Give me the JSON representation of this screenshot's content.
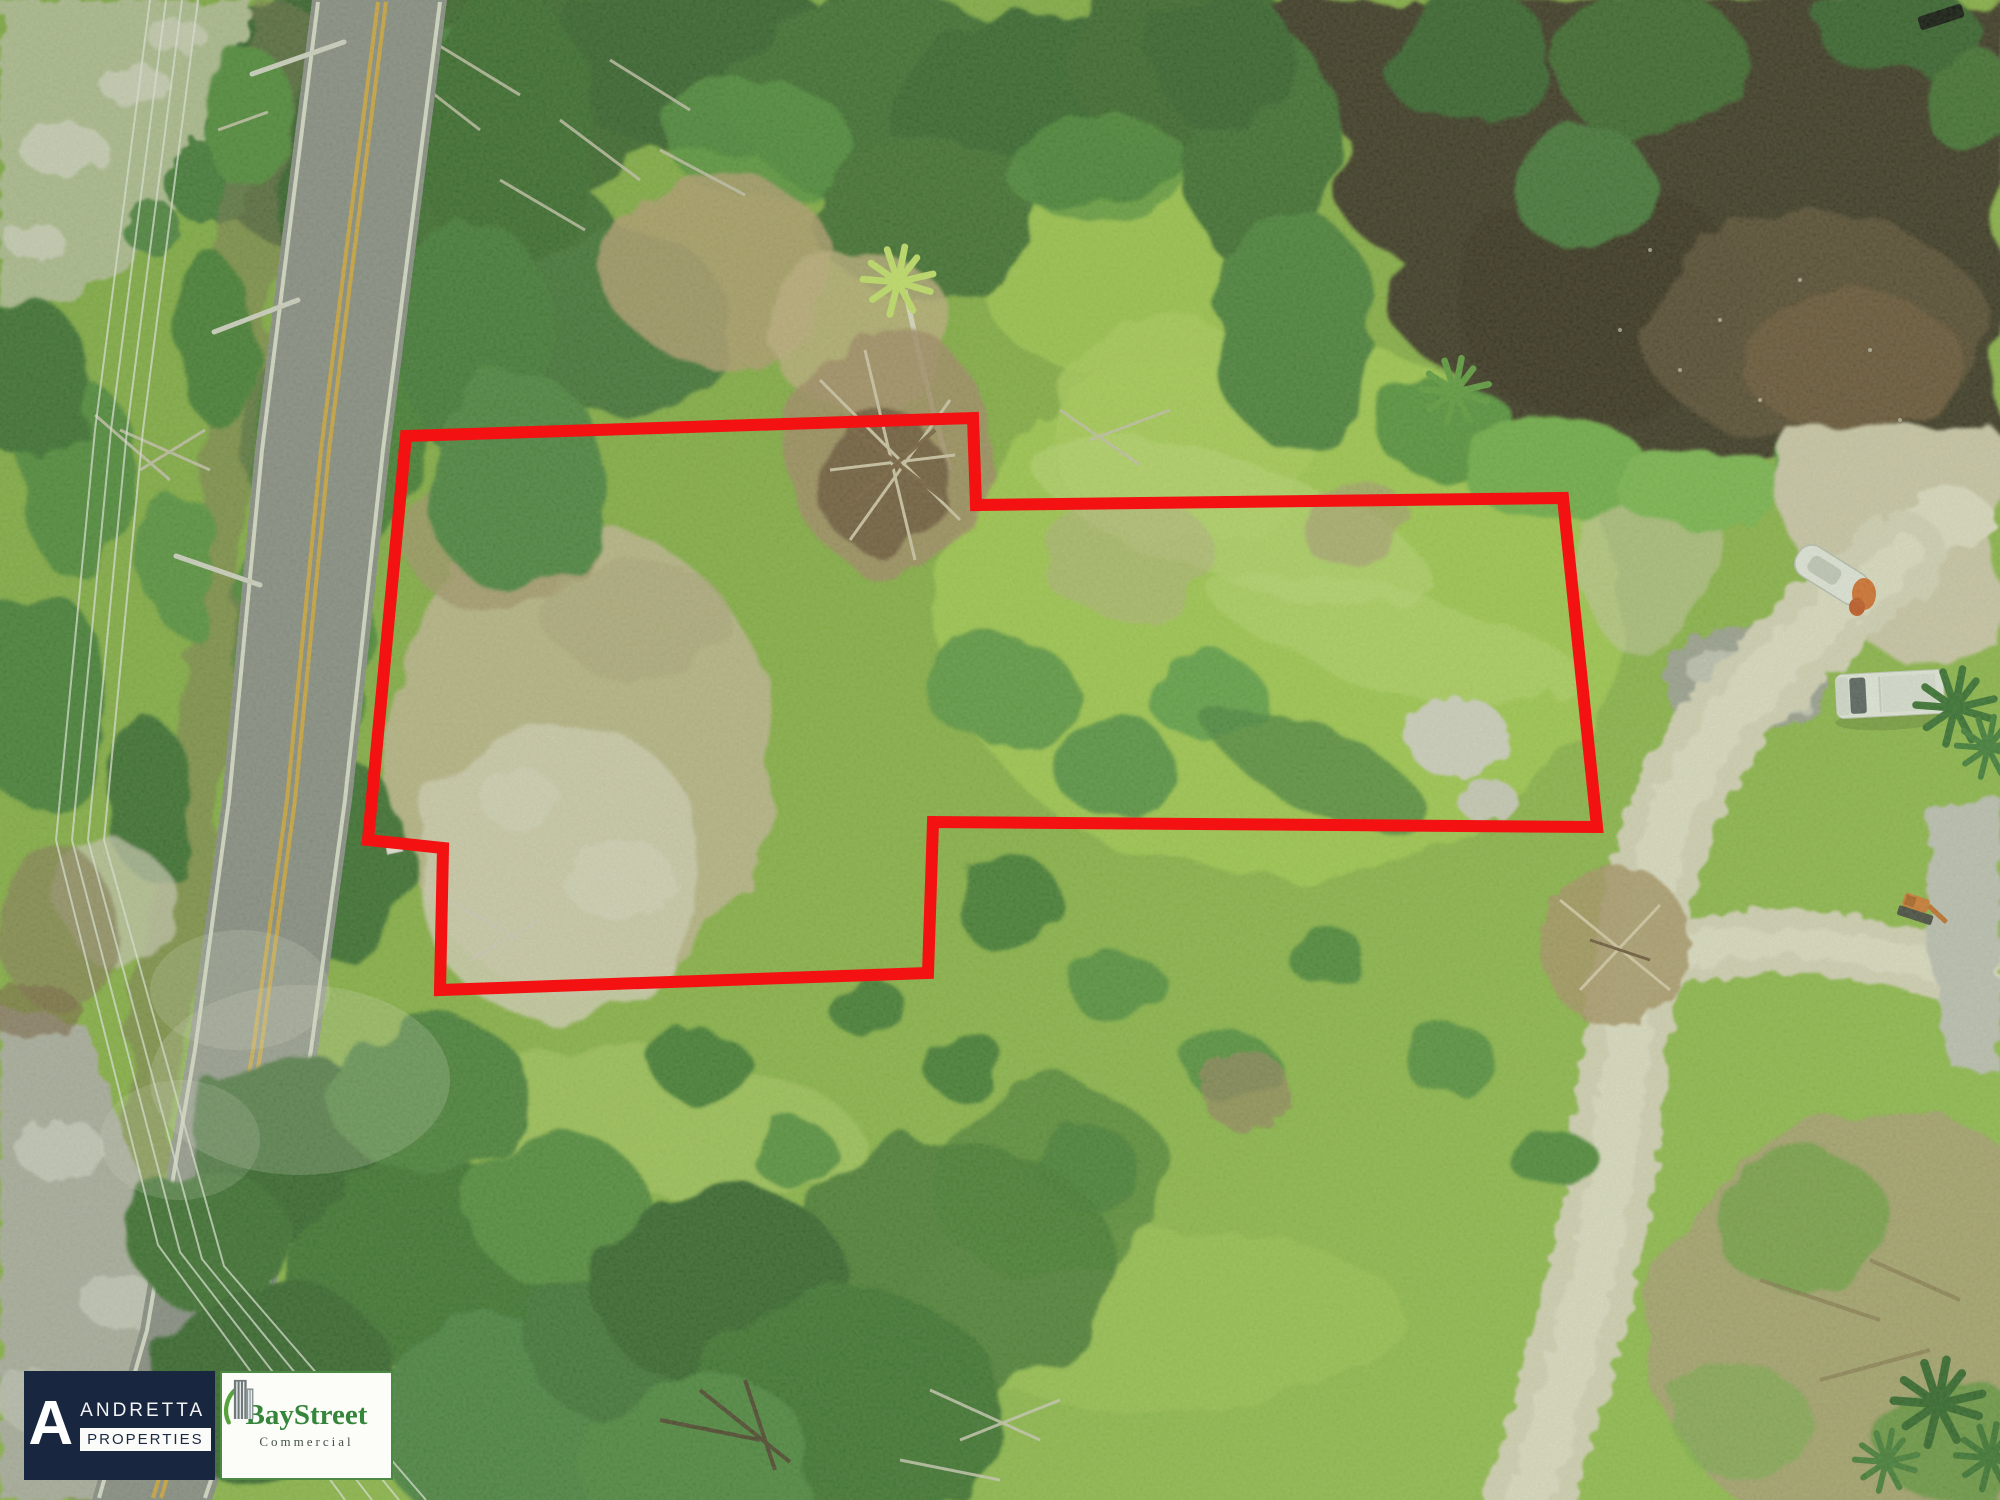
{
  "image": {
    "kind": "aerial-drone-photograph",
    "parcel_outline_color": "#f31111",
    "palette": {
      "grass_base": "#8ab342",
      "grass_bright": "#aad24f",
      "forest_dark": "#2d5a25",
      "dry_grass": "#c7ba93",
      "pond_water": "#35291f",
      "asphalt": "#8c8d8a",
      "center_line_yellow": "#d9a73c",
      "dirt_road_sand": "#e1d9c2"
    }
  },
  "branding": {
    "andretta": {
      "monogram": "A",
      "name": "ANDRETTA",
      "subtitle": "PROPERTIES",
      "bg_color": "#18273f",
      "text_color": "#ffffff"
    },
    "baystreet": {
      "name": "BayStreet",
      "subtitle": "Commercial",
      "green": "#35853a",
      "bg_color": "#ffffff",
      "icon": "building-icon"
    }
  }
}
